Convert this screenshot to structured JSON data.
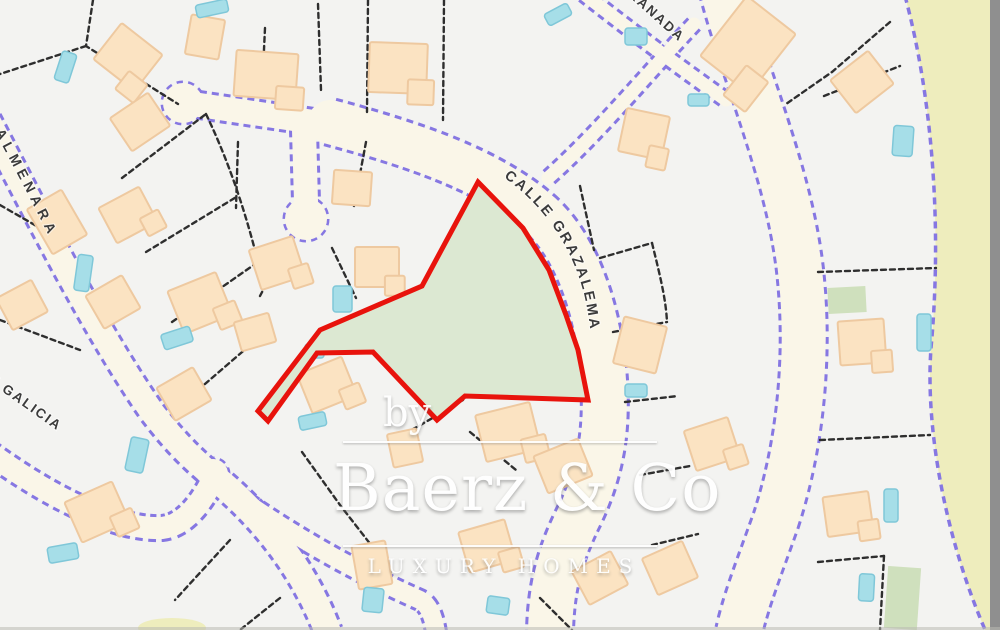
{
  "map": {
    "labels": {
      "grazalema": "CALLE GRAZALEMA",
      "granada": "RANADA",
      "almenara": "ALMENARA",
      "galicia": "E GALICIA"
    }
  },
  "watermark": {
    "by": "by",
    "brand": "Baerz & Co",
    "tagline": "LUXURY HOMES"
  },
  "colors": {
    "bg": "#f3f3f1",
    "road_fill": "#faf6e8",
    "road_edge": "#8677e2",
    "parcel_line": "#2e2e2e",
    "building_fill": "#fbe3c2",
    "building_edge": "#eec9a0",
    "pool_fill": "#a6dee8",
    "pool_edge": "#7fc7d8",
    "green_parcel": "#cfe0bd",
    "red_outline": "#e8130c",
    "red_parcel_fill": "#dce8d2",
    "offmap": "#eeedbd",
    "border_gray": "#8f8f8f"
  }
}
